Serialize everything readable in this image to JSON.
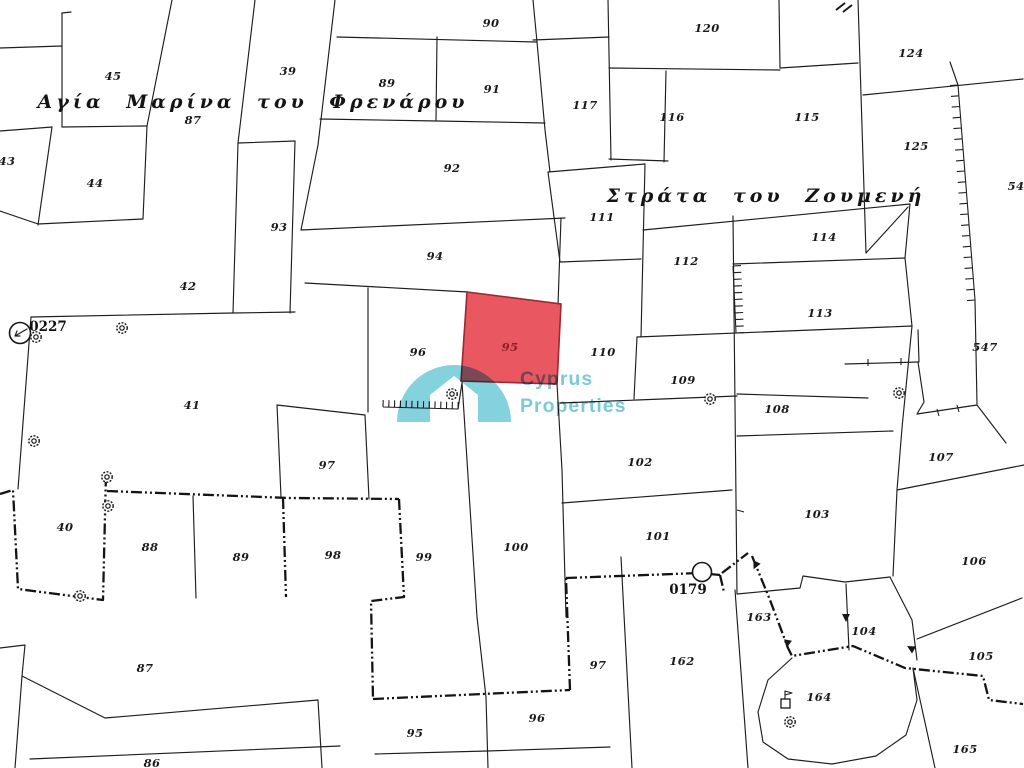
{
  "map": {
    "background": "#ffffff",
    "line_color": "#1e1e1e",
    "street_names": [
      {
        "text": "Αγία Μαρίνα του Φρενάρου"
      },
      {
        "text": "Στράτα του Ζουμενή"
      }
    ],
    "reference_points": [
      {
        "label": "0227"
      },
      {
        "label": "0179"
      }
    ],
    "highlighted_parcel": {
      "number": "95",
      "fill": "#e8515b",
      "stroke": "#9a2930",
      "label_color": "#8e1d24"
    },
    "parcel_labels": [
      {
        "n": "39",
        "x": 288,
        "y": 71
      },
      {
        "n": "45",
        "x": 113,
        "y": 76
      },
      {
        "n": "90",
        "x": 491,
        "y": 23
      },
      {
        "n": "91",
        "x": 492,
        "y": 89
      },
      {
        "n": "89",
        "x": 387,
        "y": 83
      },
      {
        "n": "87",
        "x": 193,
        "y": 120
      },
      {
        "n": "43",
        "x": 7,
        "y": 161
      },
      {
        "n": "44",
        "x": 95,
        "y": 183
      },
      {
        "n": "93",
        "x": 279,
        "y": 227
      },
      {
        "n": "42",
        "x": 188,
        "y": 286
      },
      {
        "n": "92",
        "x": 452,
        "y": 168
      },
      {
        "n": "94",
        "x": 435,
        "y": 256
      },
      {
        "n": "117",
        "x": 585,
        "y": 105
      },
      {
        "n": "116",
        "x": 672,
        "y": 117
      },
      {
        "n": "120",
        "x": 707,
        "y": 28
      },
      {
        "n": "115",
        "x": 807,
        "y": 117
      },
      {
        "n": "124",
        "x": 911,
        "y": 53
      },
      {
        "n": "125",
        "x": 916,
        "y": 146
      },
      {
        "n": "54",
        "x": 1016,
        "y": 186
      },
      {
        "n": "111",
        "x": 602,
        "y": 217
      },
      {
        "n": "112",
        "x": 686,
        "y": 261
      },
      {
        "n": "114",
        "x": 824,
        "y": 237
      },
      {
        "n": "113",
        "x": 820,
        "y": 313
      },
      {
        "n": "547",
        "x": 985,
        "y": 347
      },
      {
        "n": "96",
        "x": 418,
        "y": 352
      },
      {
        "n": "110",
        "x": 603,
        "y": 352
      },
      {
        "n": "109",
        "x": 683,
        "y": 380
      },
      {
        "n": "108",
        "x": 777,
        "y": 409
      },
      {
        "n": "102",
        "x": 640,
        "y": 462
      },
      {
        "n": "101",
        "x": 658,
        "y": 536
      },
      {
        "n": "100",
        "x": 516,
        "y": 547
      },
      {
        "n": "103",
        "x": 817,
        "y": 514
      },
      {
        "n": "107",
        "x": 941,
        "y": 457
      },
      {
        "n": "106",
        "x": 974,
        "y": 561
      },
      {
        "n": "105",
        "x": 981,
        "y": 656
      },
      {
        "n": "104",
        "x": 864,
        "y": 631
      },
      {
        "n": "41",
        "x": 192,
        "y": 405
      },
      {
        "n": "97",
        "x": 327,
        "y": 465
      },
      {
        "n": "40",
        "x": 65,
        "y": 527
      },
      {
        "n": "88",
        "x": 150,
        "y": 547
      },
      {
        "n": "89",
        "x": 241,
        "y": 557
      },
      {
        "n": "98",
        "x": 333,
        "y": 555
      },
      {
        "n": "99",
        "x": 424,
        "y": 557
      },
      {
        "n": "87",
        "x": 145,
        "y": 668
      },
      {
        "n": "86",
        "x": 152,
        "y": 763
      },
      {
        "n": "95",
        "x": 415,
        "y": 733
      },
      {
        "n": "96",
        "x": 537,
        "y": 718
      },
      {
        "n": "97",
        "x": 598,
        "y": 665
      },
      {
        "n": "162",
        "x": 682,
        "y": 661
      },
      {
        "n": "163",
        "x": 759,
        "y": 617
      },
      {
        "n": "164",
        "x": 819,
        "y": 697
      },
      {
        "n": "165",
        "x": 965,
        "y": 749
      }
    ]
  },
  "watermark": {
    "line1": "Cyprus",
    "line2": "Properties",
    "color": "#7cc9d8",
    "arch_color": "#7ed0dd"
  }
}
